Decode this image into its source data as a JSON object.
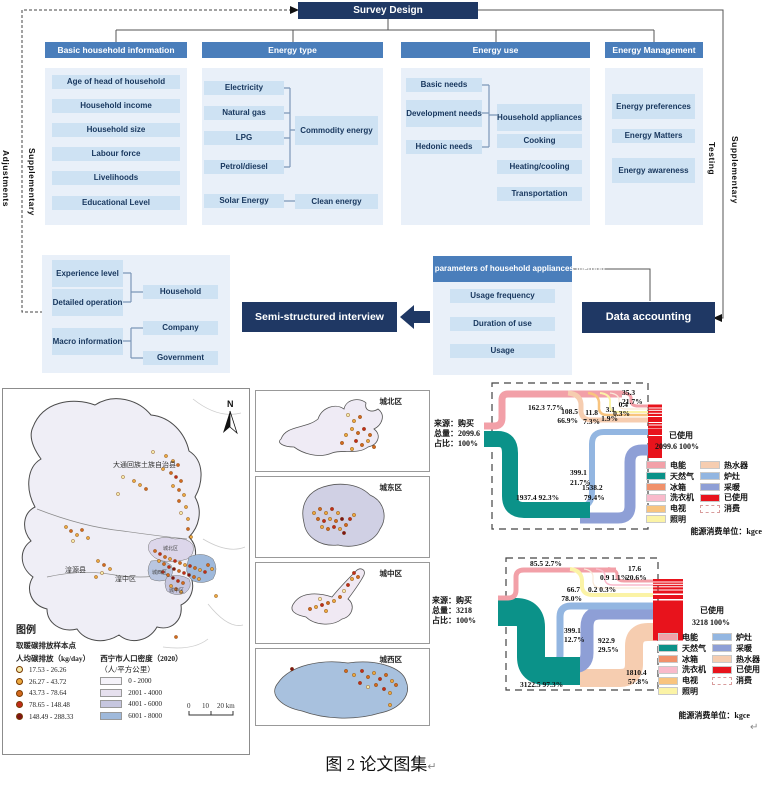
{
  "caption": {
    "text": "图 2  论文图集",
    "return_mark": "↵"
  },
  "flowchart": {
    "root": "Survey Design",
    "side_labels": {
      "left_outer": "Adjustments",
      "left_inner": "Supplementary",
      "right_inner": "Testing",
      "right_outer": "Supplementary"
    },
    "columns": [
      {
        "title": "Basic household information",
        "items": [
          "Age of head of household",
          "Household income",
          "Household size",
          "Labour force",
          "Livelihoods",
          "Educational Level"
        ]
      },
      {
        "title": "Energy type",
        "items": [
          "Electricity",
          "Natural gas",
          "LPG",
          "Petrol/diesel",
          "Solar Energy"
        ],
        "commodity": "Commodity energy",
        "clean": "Clean energy"
      },
      {
        "title": "Energy use",
        "items": [
          "Basic needs",
          "Development needs",
          "Hedonic needs"
        ],
        "targets": [
          "Household appliances",
          "Cooking",
          "Heating/cooling",
          "Transportation"
        ]
      },
      {
        "title": "Energy Management",
        "items": [
          "Energy preferences",
          "Energy Matters",
          "Energy awareness"
        ]
      }
    ],
    "interview_group": {
      "items": [
        "Experience level",
        "Detailed operation",
        "Macro information"
      ],
      "targets": [
        "Household",
        "Company",
        "Government"
      ]
    },
    "interview": "Semi-structured interview",
    "physical": {
      "title": "Physical parameters of household appliances method",
      "items": [
        "Usage frequency",
        "Duration of use",
        "Usage"
      ]
    },
    "data_accounting": "Data accounting"
  },
  "map": {
    "north": "N",
    "regions": {
      "datong": "大通回族土族自治县",
      "huangyuan": "湟源县",
      "huangzhong": "湟中区",
      "chengbei": "城北区",
      "chengxi": "城西区",
      "chengzhong": "城中区"
    },
    "legend": {
      "title": "图例",
      "points_title": "取暖碳排放样本点",
      "points_subtitle": "人均碳排放（kg/day）",
      "classes": [
        {
          "range": "17.53 - 26.26",
          "color": "#F5E9A9"
        },
        {
          "range": "26.27 - 43.72",
          "color": "#EBA83F"
        },
        {
          "range": "43.73 - 78.64",
          "color": "#D2691E"
        },
        {
          "range": "78.65 - 148.48",
          "color": "#C02B1B"
        },
        {
          "range": "148.49 - 288.33",
          "color": "#7E1416"
        }
      ],
      "density_title": "西宁市人口密度（2020）",
      "density_unit": "（人/平方公里）",
      "density_classes": [
        {
          "range": "0 - 2000",
          "color": "#F4F2F9"
        },
        {
          "range": "2001 - 4000",
          "color": "#E6E0EE"
        },
        {
          "range": "4001 - 6000",
          "color": "#C6C6DF"
        },
        {
          "range": "6001 - 8000",
          "color": "#9FB9DB"
        }
      ]
    },
    "scale": {
      "t0": "0",
      "t1": "10",
      "t2": "20 km"
    },
    "insets": [
      "城北区",
      "城东区",
      "城中区",
      "城西区"
    ]
  },
  "sankey1": {
    "source": [
      "来源：购买",
      "总量：2099.6",
      "占比：100%"
    ],
    "labels": {
      "electric": "162.3   7.7%",
      "gas": "1937.4   92.3%",
      "water_a": "108.5",
      "water_b": "66.9%",
      "tv_a": "11.8",
      "tv_b": "7.3%",
      "light_a": "3.1",
      "light_b": "1.9%",
      "other_a": "0.4",
      "other_b": "0.3%",
      "direct_a": "35.3",
      "direct_b": "21.7%",
      "stove_a": "399.1",
      "stove_b": "21.7%",
      "heat_a": "1538.2",
      "heat_b": "79.4%"
    },
    "used": {
      "label": "已使用",
      "value": "2099.6   100%"
    },
    "unit": "能源消费单位：kgce",
    "legend": {
      "col1": [
        {
          "label": "电能",
          "color": "#F2A0A8"
        },
        {
          "label": "天然气",
          "color": "#0B9289"
        },
        {
          "label": "冰箱",
          "color": "#F0916B"
        },
        {
          "label": "洗衣机",
          "color": "#F9BACB"
        },
        {
          "label": "电视",
          "color": "#F8C47F"
        },
        {
          "label": "照明",
          "color": "#FBF3A6"
        }
      ],
      "col2": [
        {
          "label": "热水器",
          "color": "#F6CDB0"
        },
        {
          "label": "炉灶",
          "color": "#93B6E1"
        },
        {
          "label": "采暖",
          "color": "#8E9FD6"
        },
        {
          "label": "已使用",
          "color": "#E8131C"
        },
        {
          "label": "消费",
          "color": "#FFFFFF"
        }
      ]
    }
  },
  "sankey2": {
    "source": [
      "来源：购买",
      "总量：3218",
      "占比：100%"
    ],
    "labels": {
      "electric": "85.5   2.7%",
      "gas": "3122.5   97.3%",
      "light_a": "66.7",
      "light_b": "78.0%",
      "f2": "0.2 0.3%",
      "f3": "0.9 1.1%",
      "direct_a": "17.6",
      "direct_b": "20.6%",
      "stove_a": "399.1",
      "stove_b": "12.7%",
      "heat_a": "922.9",
      "heat_b": "29.5%",
      "water_a": "1810.4",
      "water_b": "57.8%"
    },
    "used": {
      "label": "已使用",
      "value": "3218   100%"
    },
    "unit": "能源消费单位：kgce",
    "legend": {
      "col1": [
        {
          "label": "电能",
          "color": "#F2A0A8"
        },
        {
          "label": "天然气",
          "color": "#0B9289"
        },
        {
          "label": "冰箱",
          "color": "#F0916B"
        },
        {
          "label": "洗衣机",
          "color": "#F9BACB"
        },
        {
          "label": "电视",
          "color": "#F8C47F"
        },
        {
          "label": "照明",
          "color": "#FBF3A6"
        }
      ],
      "col2": [
        {
          "label": "炉灶",
          "color": "#93B6E1"
        },
        {
          "label": "采暖",
          "color": "#8E9FD6"
        },
        {
          "label": "热水器",
          "color": "#F6CDB0"
        },
        {
          "label": "已使用",
          "color": "#E8131C"
        },
        {
          "label": "消费",
          "color": "#FFFFFF"
        }
      ]
    }
  },
  "chart_data": [
    {
      "type": "sankey",
      "unit": "kgce",
      "source": "购买",
      "total": 2099.6,
      "total_percent": 100,
      "links": [
        {
          "from": "购买",
          "to": "电能",
          "value": 162.3,
          "percent": 7.7
        },
        {
          "from": "购买",
          "to": "天然气",
          "value": 1937.4,
          "percent": 92.3
        },
        {
          "from": "电能",
          "to": "热水器",
          "value": 108.5,
          "percent": 66.9
        },
        {
          "from": "电能",
          "value": 11.8,
          "percent": 7.3
        },
        {
          "from": "电能",
          "value": 3.1,
          "percent": 1.9
        },
        {
          "from": "电能",
          "value": 0.4,
          "percent": 0.3
        },
        {
          "from": "电能",
          "value": 35.3,
          "percent": 21.7
        },
        {
          "from": "天然气",
          "to": "炉灶",
          "value": 399.1,
          "percent": 21.7
        },
        {
          "from": "天然气",
          "to": "采暖",
          "value": 1538.2,
          "percent": 79.4
        }
      ],
      "sink": {
        "label": "已使用",
        "value": 2099.6,
        "percent": 100
      }
    },
    {
      "type": "sankey",
      "unit": "kgce",
      "source": "购买",
      "total": 3218,
      "total_percent": 100,
      "links": [
        {
          "from": "购买",
          "to": "电能",
          "value": 85.5,
          "percent": 2.7
        },
        {
          "from": "购买",
          "to": "天然气",
          "value": 3122.5,
          "percent": 97.3
        },
        {
          "from": "电能",
          "to": "照明",
          "value": 66.7,
          "percent": 78.0
        },
        {
          "from": "电能",
          "value": 0.2,
          "percent": 0.3
        },
        {
          "from": "电能",
          "value": 0.9,
          "percent": 1.1
        },
        {
          "from": "电能",
          "value": 17.6,
          "percent": 20.6
        },
        {
          "from": "天然气",
          "to": "炉灶",
          "value": 399.1,
          "percent": 12.7
        },
        {
          "from": "天然气",
          "to": "采暖",
          "value": 922.9,
          "percent": 29.5
        },
        {
          "from": "天然气",
          "to": "热水器",
          "value": 1810.4,
          "percent": 57.8
        }
      ],
      "sink": {
        "label": "已使用",
        "value": 3218,
        "percent": 100
      }
    }
  ]
}
